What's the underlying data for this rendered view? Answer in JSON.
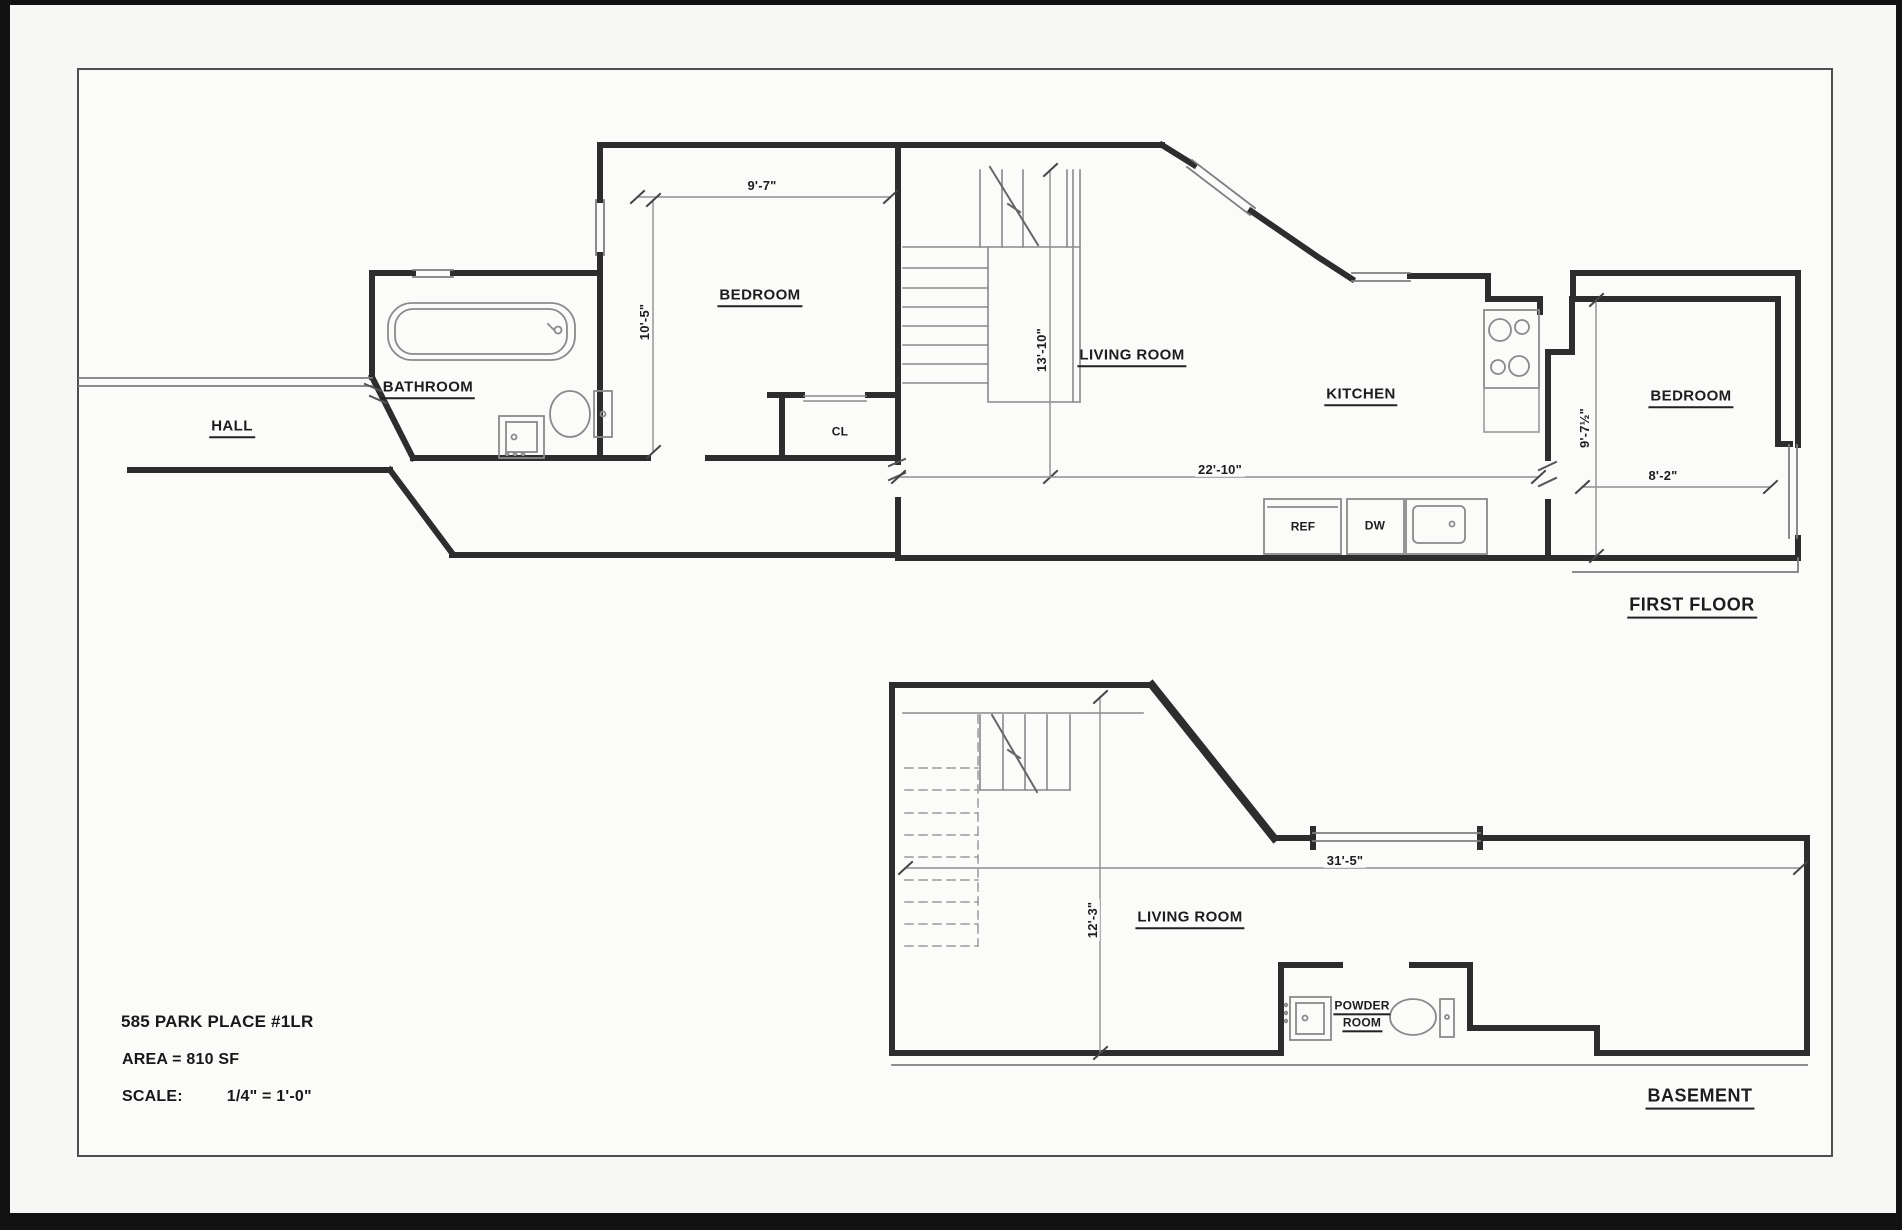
{
  "first_floor": {
    "title": "FIRST FLOOR",
    "rooms": {
      "hall": "HALL",
      "bathroom": "BATHROOM",
      "bedroom_left": "BEDROOM",
      "closet": "CL",
      "living_room": "LIVING ROOM",
      "kitchen": "KITCHEN",
      "bedroom_right": "BEDROOM"
    },
    "appliances": {
      "refrigerator": "REF",
      "dishwasher": "DW"
    },
    "dimensions": {
      "bedroom_left_width": "9'-7\"",
      "bedroom_left_depth": "10'-5\"",
      "living_room_depth": "13'-10\"",
      "living_kitchen_width": "22'-10\"",
      "bedroom_right_depth": "9'-7½\"",
      "bedroom_right_width": "8'-2\""
    }
  },
  "basement": {
    "title": "BASEMENT",
    "rooms": {
      "living_room": "LIVING ROOM",
      "powder_room_line1": "POWDER",
      "powder_room_line2": "ROOM"
    },
    "dimensions": {
      "overall_width": "31'-5\"",
      "living_room_depth": "12'-3\""
    }
  },
  "title_block": {
    "address": "585 PARK PLACE #1LR",
    "area": "AREA = 810 SF",
    "scale_label": "SCALE:",
    "scale_value": "1/4\" = 1'-0\""
  }
}
